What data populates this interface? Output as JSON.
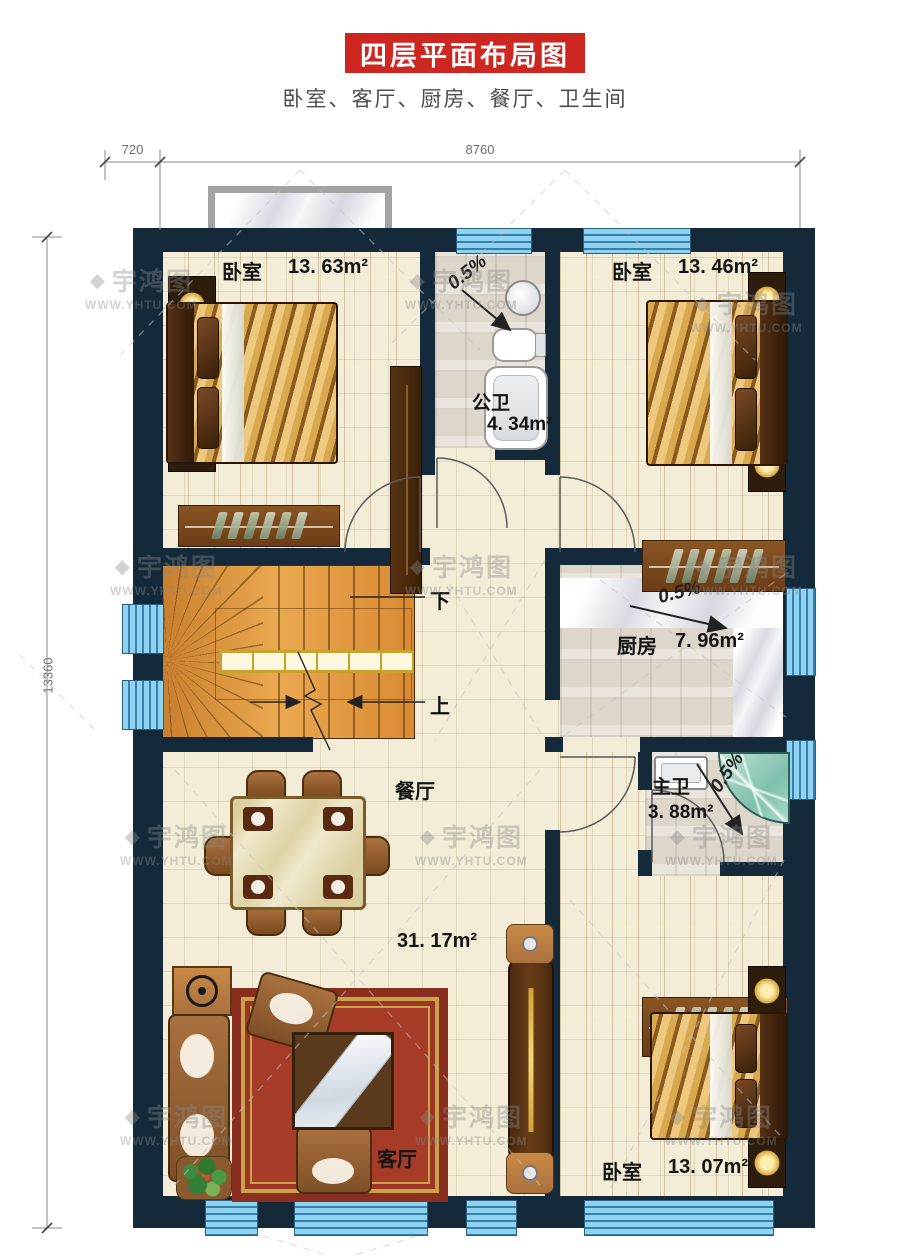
{
  "title": "四层平面布局图",
  "subtitle": "卧室、客厅、厨房、餐厅、卫生间",
  "dimensions": {
    "top_segment": "720",
    "top_main": "8760",
    "left_total": "13360"
  },
  "watermark": {
    "brand": "宇鸿图",
    "icon": "◆",
    "site": "WWW.YHTU.COM"
  },
  "slope_label": "0.5%",
  "stairs": {
    "down": "下",
    "up": "上"
  },
  "rooms": {
    "bedroom_top_left": {
      "name": "卧室",
      "area": "13. 63m²"
    },
    "bath_public": {
      "name": "公卫",
      "area": "4. 34m²"
    },
    "bedroom_top_right": {
      "name": "卧室",
      "area": "13. 46m²"
    },
    "kitchen": {
      "name": "厨房",
      "area": "7. 96m²"
    },
    "dining": {
      "name": "餐厅"
    },
    "living": {
      "name": "客厅",
      "area": "31. 17m²"
    },
    "bath_master": {
      "name": "主卫",
      "area": "3. 88m²"
    },
    "bedroom_bottom_right": {
      "name": "卧室",
      "area": "13. 07m²"
    }
  },
  "colors": {
    "accent_red": "#ce2721",
    "wall": "#142a3b",
    "window_blue": "#8ed4f2"
  }
}
